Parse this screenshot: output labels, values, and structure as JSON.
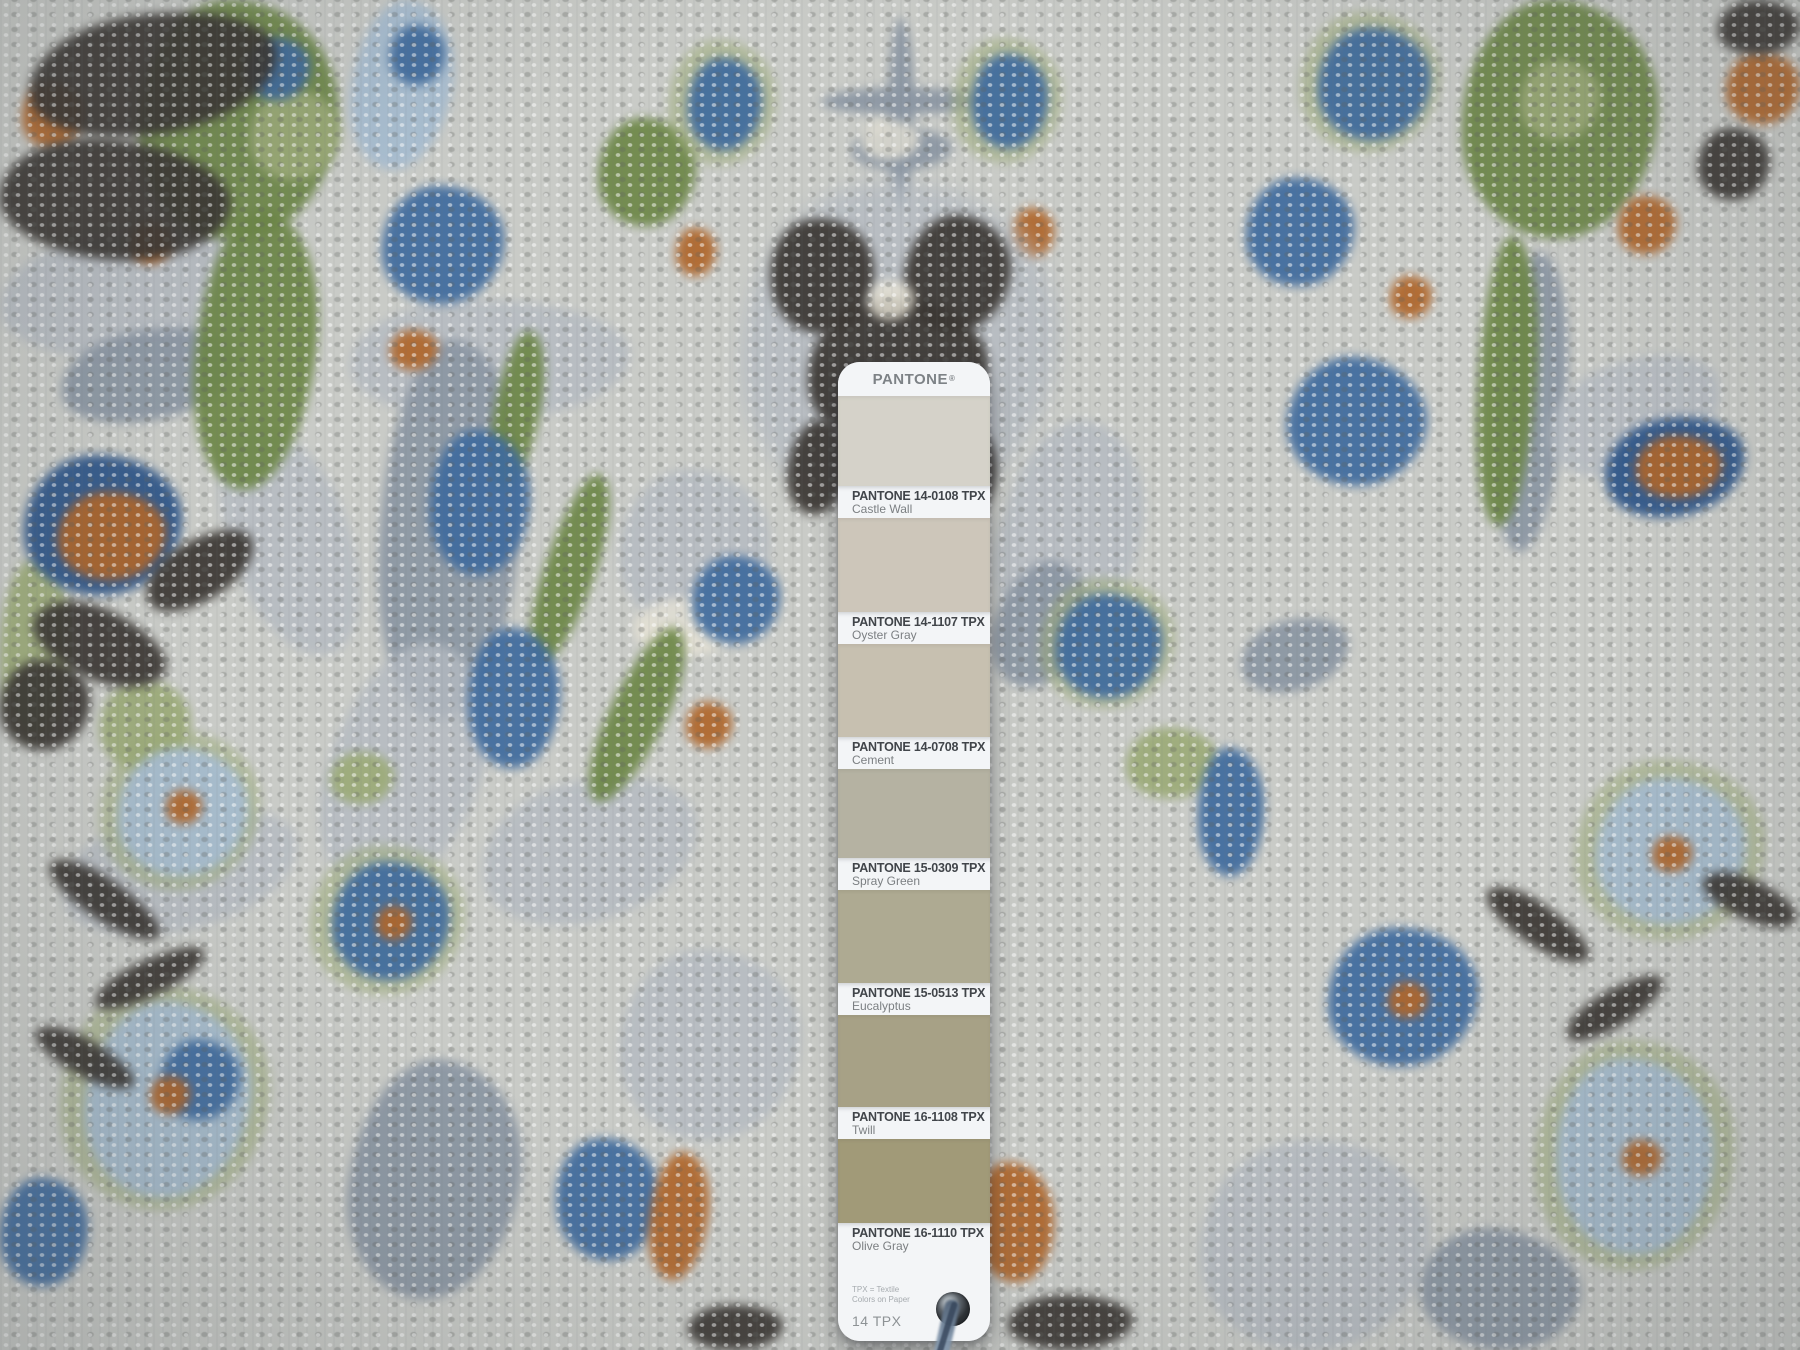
{
  "rug": {
    "palette": {
      "field": "#c9cbc7",
      "slate_gray": "#8b96a3",
      "blue": "#3f6b9e",
      "light_blue": "#a7bdd1",
      "green": "#6d8747",
      "light_green": "#9cab78",
      "rust": "#b0662a",
      "charcoal": "#3b3733",
      "ivory": "#e9e5d7"
    }
  },
  "pantone_card": {
    "brand": "PANTONE",
    "registered_mark": "®",
    "swatches": [
      {
        "code": "PANTONE 14-0108 TPX",
        "name": "Castle Wall",
        "color": "#d5d2c9"
      },
      {
        "code": "PANTONE 14-1107 TPX",
        "name": "Oyster Gray",
        "color": "#cdc6ba"
      },
      {
        "code": "PANTONE 14-0708 TPX",
        "name": "Cement",
        "color": "#c7c0b0"
      },
      {
        "code": "PANTONE 15-0309 TPX",
        "name": "Spray Green",
        "color": "#b5b2a2"
      },
      {
        "code": "PANTONE 15-0513 TPX",
        "name": "Eucalyptus",
        "color": "#aeaa92"
      },
      {
        "code": "PANTONE 16-1108 TPX",
        "name": "Twill",
        "color": "#a7a186"
      },
      {
        "code": "PANTONE 16-1110 TPX",
        "name": "Olive Gray",
        "color": "#a19a78"
      }
    ],
    "footer": {
      "note_line1": "TPX = Textile",
      "note_line2": "Colors on Paper",
      "count_label": "14 TPX"
    }
  }
}
